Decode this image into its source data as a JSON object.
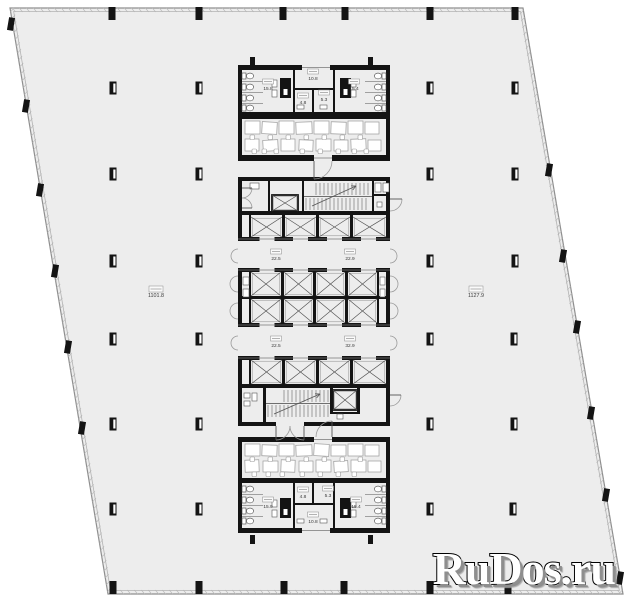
{
  "watermark": {
    "text": "RuDos.ru"
  },
  "colors": {
    "floor": "#ededed",
    "wall": "#141414",
    "outline": "#8f8f8f",
    "inner_line": "#b3b3b3",
    "furniture": "#9b9b9b",
    "label": "#3a3a3a",
    "watermark_fill": "#ffffff",
    "watermark_outline": "#000000",
    "watermark_shadow": "#8e8e8e"
  },
  "area_labels": [
    {
      "id": "lobby-top",
      "x": 313,
      "y": 80,
      "text": "10.8"
    },
    {
      "id": "wc-top-left",
      "x": 268,
      "y": 90,
      "text": "15.8"
    },
    {
      "id": "room-top-48",
      "x": 303,
      "y": 104,
      "text": "4.8"
    },
    {
      "id": "room-top-53",
      "x": 324,
      "y": 101,
      "text": "5.3"
    },
    {
      "id": "wc-top-right",
      "x": 354,
      "y": 90,
      "text": "15.4"
    },
    {
      "id": "lift-hall-1-left",
      "x": 276,
      "y": 260,
      "text": "22.5"
    },
    {
      "id": "lift-hall-1-right",
      "x": 350,
      "y": 260,
      "text": "22.9"
    },
    {
      "id": "lift-hall-2-left",
      "x": 276,
      "y": 347,
      "text": "22.5"
    },
    {
      "id": "lift-hall-2-right",
      "x": 350,
      "y": 347,
      "text": "32.9"
    },
    {
      "id": "open-office-left",
      "x": 156,
      "y": 297,
      "text": "1101.8",
      "big": true
    },
    {
      "id": "open-office-right",
      "x": 476,
      "y": 297,
      "text": "1127.9",
      "big": true
    },
    {
      "id": "room-bot-48",
      "x": 303,
      "y": 498,
      "text": "4.8"
    },
    {
      "id": "room-bot-53",
      "x": 328,
      "y": 497,
      "text": "5.3"
    },
    {
      "id": "wc-bot-left",
      "x": 268,
      "y": 508,
      "text": "15.9"
    },
    {
      "id": "wc-bot-right",
      "x": 356,
      "y": 508,
      "text": "15.4"
    },
    {
      "id": "lobby-bottom",
      "x": 313,
      "y": 523,
      "text": "10.8"
    }
  ]
}
